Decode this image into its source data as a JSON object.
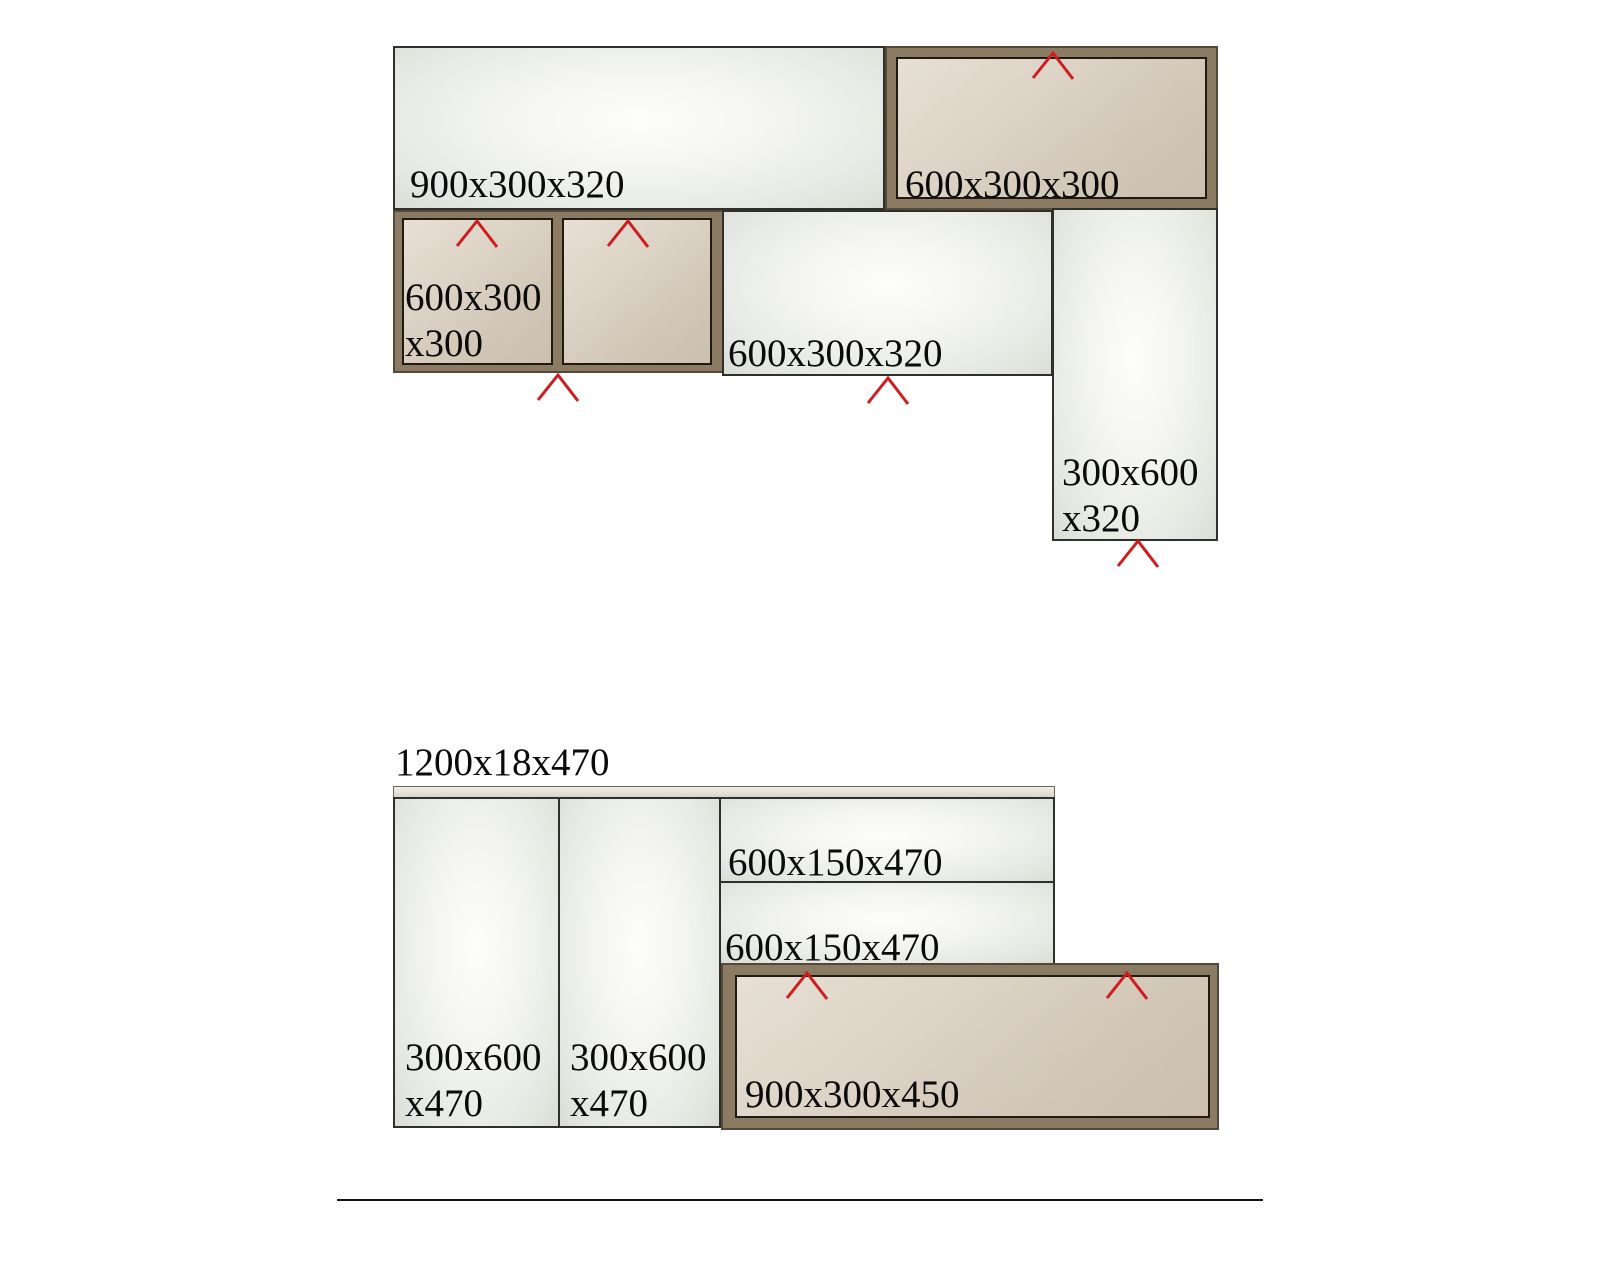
{
  "colors": {
    "arrow_red": "#cf1d1d",
    "frame_brown": "#8a7b62",
    "frame_edge": "#52493a",
    "door_tan": "#d6cbbc",
    "panel_light": "#eef0eb",
    "text_black": "#0b0b0b"
  },
  "top_assembly": {
    "shelf_900": {
      "label": "900x300x320"
    },
    "wall_cabinet_600": {
      "label": "600x300x300"
    },
    "wall_cabinet_double": {
      "label_line1": "600x300",
      "label_line2": "x300"
    },
    "shelf_600": {
      "label": "600x300x320"
    },
    "side_panel_300": {
      "label_line1": "300x600",
      "label_line2": "x320"
    }
  },
  "bottom_assembly": {
    "worktop": {
      "label": "1200x18x470"
    },
    "tall_panel_left": {
      "label_line1": "300x600",
      "label_line2": "x470"
    },
    "tall_panel_right": {
      "label_line1": "300x600",
      "label_line2": "x470"
    },
    "drawer_upper": {
      "label": "600x150x470"
    },
    "drawer_lower": {
      "label": "600x150x470"
    },
    "base_cabinet_900": {
      "label": "900x300x450"
    }
  }
}
